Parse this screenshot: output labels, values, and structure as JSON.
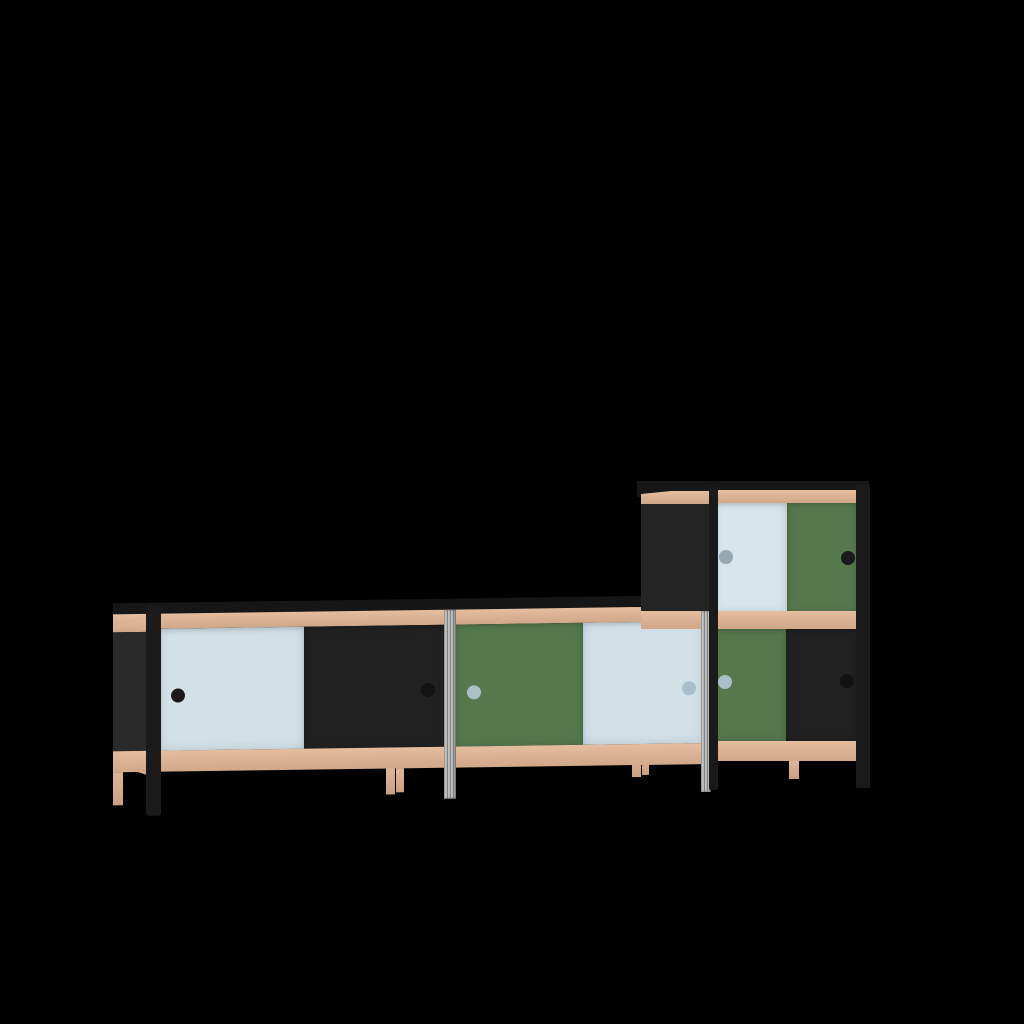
{
  "scene": {
    "description": "3D product render of a modular sideboard with sliding doors: a long three-module low cabinet with a one-module cabinet stacked on the right end, shown on a plain black background",
    "background": "#000000"
  },
  "palette": {
    "background": "#000000",
    "top_slab": "#161616",
    "frame_black": "#1a1a1a",
    "panel_black": "#2a2a2a",
    "panel_black_upper": "#242424",
    "wood": "#e2b694",
    "wood_leg": "#dcae8c",
    "door_blue": "#d2e0e8",
    "door_blue_light": "#d8e5ec",
    "door_green": "#55794d",
    "door_black": "#212121",
    "post_grey": "#b4b7b5",
    "handle_dark": "#1a1a1a",
    "handle_darker": "#121212",
    "handle_blue_grey": "#a9bfca",
    "handle_grey": "#97a7b2"
  },
  "furniture": {
    "lower_sideboard": {
      "modules": [
        {
          "id": "left",
          "doors": [
            {
              "color": "blue",
              "handle": "black",
              "handle_side": "left"
            },
            {
              "color": "black",
              "handle": "black",
              "handle_side": "right"
            }
          ]
        },
        {
          "id": "middle",
          "doors": [
            {
              "color": "green",
              "handle": "blue-grey",
              "handle_side": "left"
            },
            {
              "color": "blue",
              "handle": "blue-grey",
              "handle_side": "right"
            }
          ]
        },
        {
          "id": "right",
          "doors": [
            {
              "color": "green",
              "handle": "blue-grey",
              "handle_side": "left"
            },
            {
              "color": "black",
              "handle": "black",
              "handle_side": "right"
            }
          ]
        }
      ],
      "frame": "black steel with beech wood rails and mixed beech / black / aluminium legs"
    },
    "stacked_cabinet": {
      "position": "on top of right module",
      "doors": [
        {
          "color": "blue",
          "handle": "grey",
          "handle_side": "left"
        },
        {
          "color": "green",
          "handle": "black",
          "handle_side": "right"
        }
      ]
    }
  }
}
